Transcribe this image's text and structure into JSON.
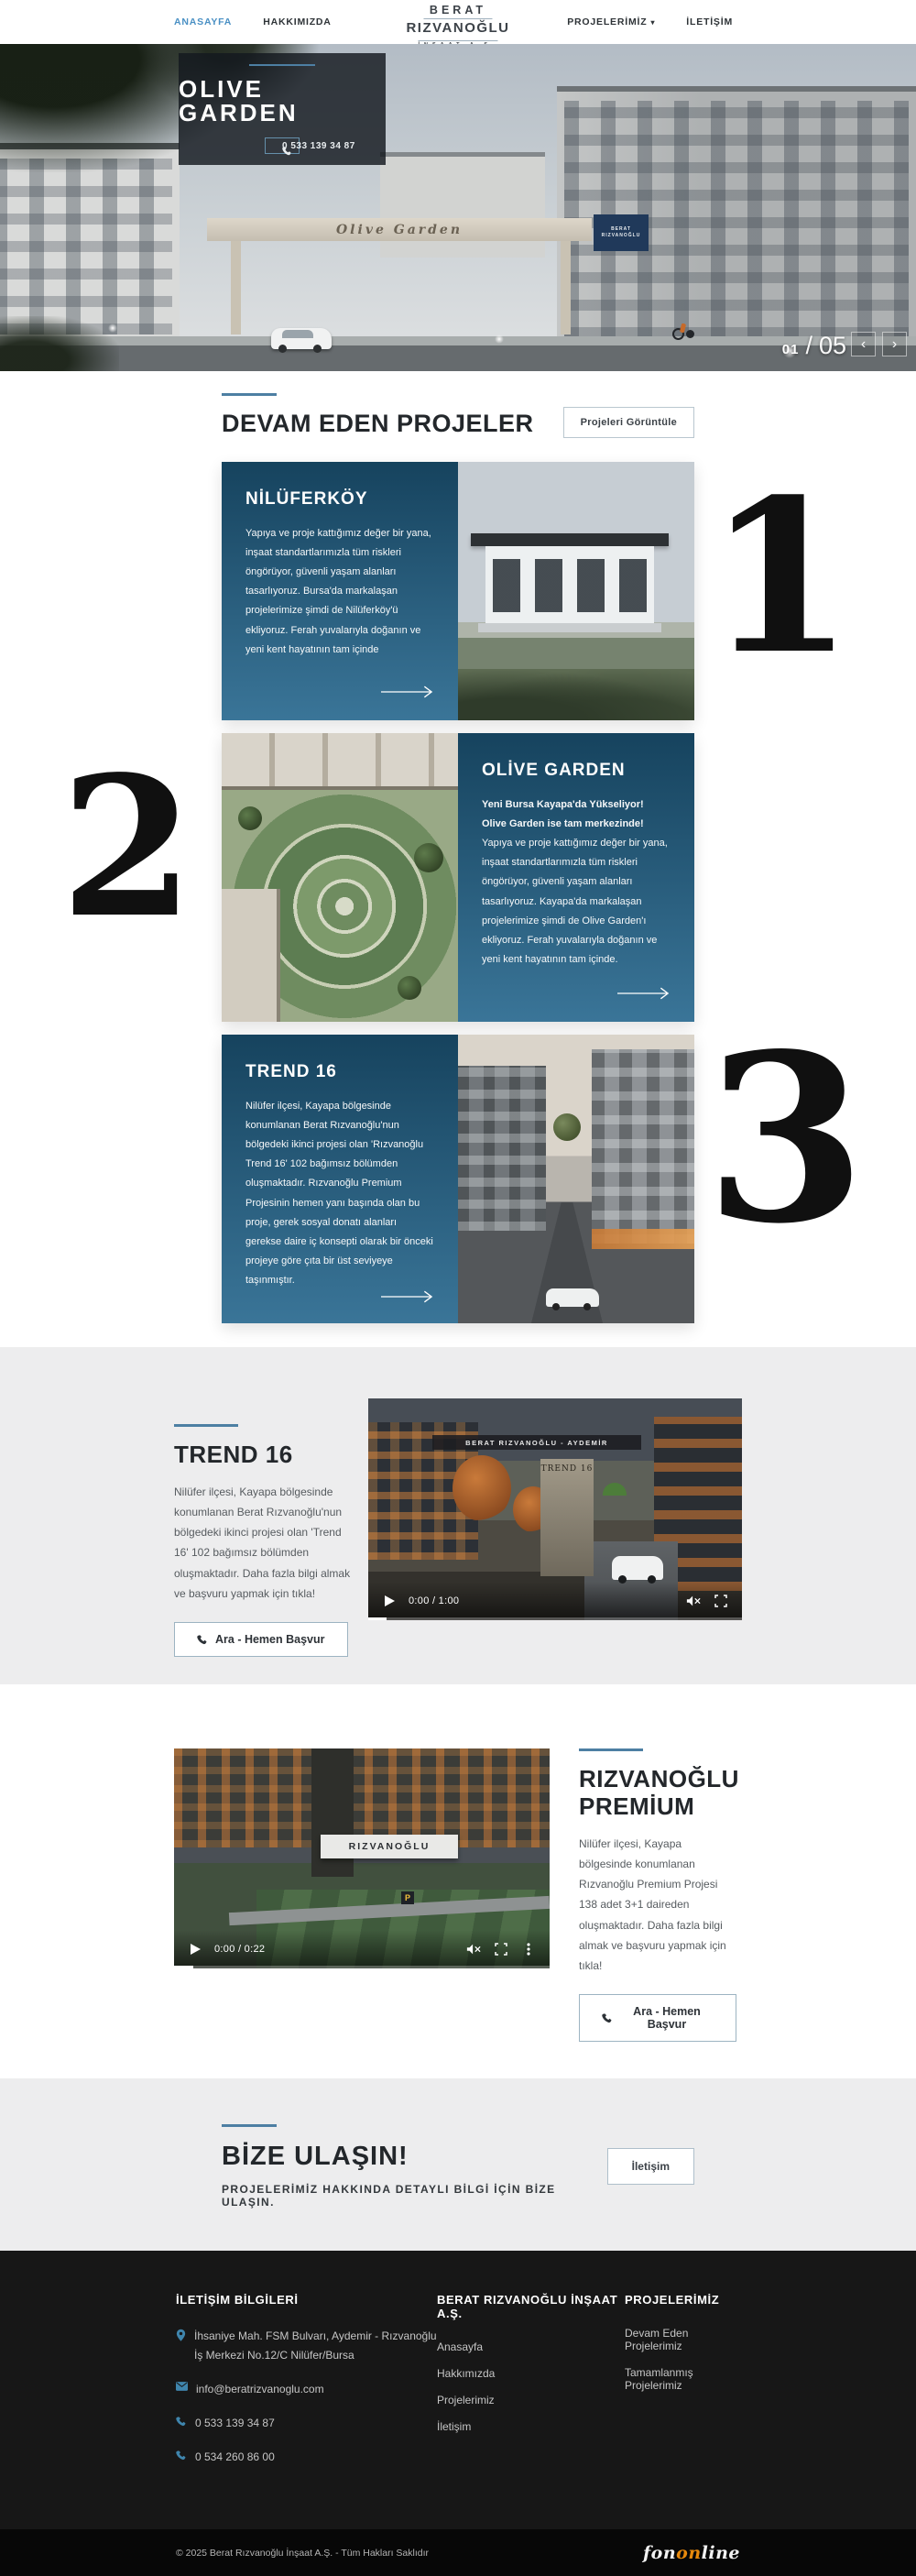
{
  "colors": {
    "accent": "#4a90c4",
    "divider": "#4d7fa3",
    "panel_top": "#16435e",
    "panel_bottom": "#3a7598",
    "footer_bg": "#171717",
    "agency_orange": "#e8890c"
  },
  "header": {
    "nav_left": [
      {
        "label": "ANASAYFA"
      },
      {
        "label": "HAKKIMIZDA"
      }
    ],
    "logo": {
      "line1": "BERAT",
      "line2": "RIZVANOĞLU",
      "line3": "İNŞAAT A.Ş."
    },
    "nav_right": [
      {
        "label": "PROJELERİMİZ",
        "caret": "▾"
      },
      {
        "label": "İLETİŞİM"
      }
    ]
  },
  "hero": {
    "title": "OLIVE GARDEN",
    "phone_button": "0 533 139 34 87",
    "gate_sign": "Olive Garden",
    "board_line1": "BERAT",
    "board_line2": "RIZVANOĞLU",
    "slide_current": "01",
    "slide_sep": "/",
    "slide_total": "05",
    "prev": "‹",
    "next": "›"
  },
  "projects": {
    "heading": "DEVAM EDEN PROJELER",
    "view_button": "Projeleri Görüntüle",
    "cards": [
      {
        "number": "1",
        "title": "NİLÜFERKÖY",
        "body": "Yapıya ve proje kattığımız değer bir yana, inşaat standartlarımızla tüm riskleri öngörüyor, güvenli yaşam alanları tasarlıyoruz. Bursa'da markalaşan projelerimize şimdi de Nilüferköy'ü ekliyoruz. Ferah yuvalarıyla doğanın ve yeni kent hayatının tam içinde"
      },
      {
        "number": "2",
        "title": "OLİVE GARDEN",
        "body_bold": "Yeni Bursa Kayapa'da Yükseliyor! Olive Garden ise tam merkezinde!",
        "body": " Yapıya ve proje kattığımız değer bir yana, inşaat standartlarımızla tüm riskleri öngörüyor, güvenli yaşam alanları tasarlıyoruz. Kayapa'da markalaşan projelerimize şimdi de Olive Garden'ı ekliyoruz. Ferah yuvalarıyla doğanın ve yeni kent hayatının tam içinde."
      },
      {
        "number": "3",
        "title": "TREND 16",
        "body": "Nilüfer ilçesi, Kayapa bölgesinde konumlanan Berat Rızvanoğlu'nun bölgedeki ikinci projesi olan 'Rızvanoğlu Trend 16' 102 bağımsız bölümden oluşmaktadır. Rızvanoğlu Premium Projesinin hemen yanı başında olan bu proje, gerek sosyal donatı alanları gerekse daire iç konsepti olarak bir önceki projeye göre çıta bir üst seviyeye taşınmıştır."
      }
    ]
  },
  "trend16_section": {
    "heading": "TREND 16",
    "body": "Nilüfer ilçesi, Kayapa bölgesinde konumlanan Berat Rızvanoğlu'nun bölgedeki ikinci projesi olan 'Trend 16' 102 bağımsız bölümden oluşmaktadır. Daha fazla bilgi almak ve başvuru yapmak için tıkla!",
    "cta": "Ara - Hemen Başvur",
    "video": {
      "time": "0:00 / 1:00",
      "gate_sign": "BERAT RIZVANOĞLU - AYDEMİR",
      "monument": "TREND 16"
    }
  },
  "premium_section": {
    "heading_line1": "RIZVANOĞLU",
    "heading_line2": "PREMİUM",
    "body": "Nilüfer ilçesi, Kayapa bölgesinde konumlanan Rızvanoğlu Premium Projesi 138 adet 3+1 daireden oluşmaktadır. Daha fazla bilgi almak ve başvuru yapmak için tıkla!",
    "cta": "Ara - Hemen Başvur",
    "video": {
      "time": "0:00 / 0:22",
      "canopy_sign": "RIZVANOĞLU",
      "parking": "P"
    }
  },
  "contact_cta": {
    "heading": "BİZE ULAŞIN!",
    "subheading": "PROJELERİMİZ HAKKINDA DETAYLI BİLGİ İÇİN BİZE ULAŞIN.",
    "button": "İletişim"
  },
  "footer": {
    "col1": {
      "heading": "İLETİŞİM BİLGİLERİ",
      "address": "İhsaniye Mah. FSM Bulvarı, Aydemir - Rızvanoğlu İş Merkezi No.12/C Nilüfer/Bursa",
      "email": "info@beratrizvanoglu.com",
      "phone1": "0 533 139 34 87",
      "phone2": "0 534 260 86 00"
    },
    "col2": {
      "heading": "BERAT RIZVANOĞLU İNŞAAT A.Ş.",
      "links": [
        "Anasayfa",
        "Hakkımızda",
        "Projelerimiz",
        "İletişim"
      ]
    },
    "col3": {
      "heading": "PROJELERİMİZ",
      "links": [
        "Devam Eden Projelerimiz",
        "Tamamlanmış Projelerimiz"
      ]
    }
  },
  "copyright": {
    "text": "© 2025 Berat Rızvanoğlu İnşaat A.Ş. - Tüm Hakları Saklıdır",
    "agency_part1": "fon",
    "agency_part2": "on",
    "agency_part3": "line"
  }
}
